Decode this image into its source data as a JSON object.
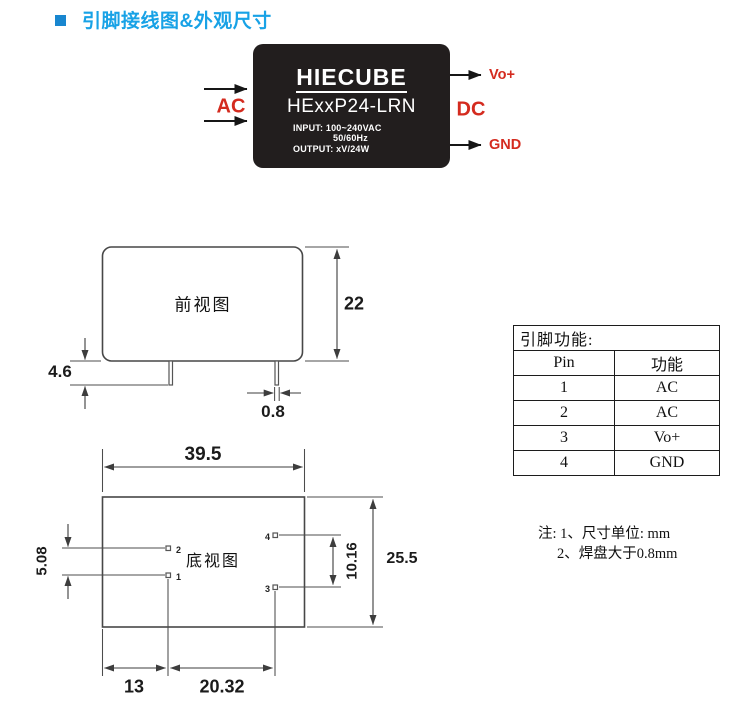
{
  "header": {
    "title": "引脚接线图&外观尺寸"
  },
  "module": {
    "brand": "HIECUBE",
    "model": "HExxP24-LRN",
    "spec_input": "INPUT: 100~240VAC",
    "spec_freq": "50/60Hz",
    "spec_output": "OUTPUT: xV/24W",
    "input_label": "AC",
    "output_label": "DC",
    "pin_vo_label": "Vo+",
    "pin_gnd_label": "GND"
  },
  "front_view": {
    "label": "前视图",
    "dim_height": "22",
    "dim_pin_length": "4.6",
    "dim_pin_width": "0.8"
  },
  "bottom_view": {
    "label": "底视图",
    "dim_width": "39.5",
    "dim_pitch_left": "5.08",
    "dim_depth": "25.5",
    "dim_pitch_right": "10.16",
    "dim_left_offset": "13",
    "dim_pin_span": "20.32",
    "pin1": "1",
    "pin2": "2",
    "pin3": "3",
    "pin4": "4"
  },
  "pin_table": {
    "title": "引脚功能:",
    "col_pin": "Pin",
    "col_func": "功能",
    "rows": [
      {
        "pin": "1",
        "func": "AC"
      },
      {
        "pin": "2",
        "func": "AC"
      },
      {
        "pin": "3",
        "func": "Vo+"
      },
      {
        "pin": "4",
        "func": "GND"
      }
    ]
  },
  "notes": {
    "line1": "注: 1、尺寸单位: mm",
    "line2": "2、焊盘大于0.8mm"
  },
  "colors": {
    "accent_blue": "#18a2e6",
    "label_red": "#d42b1f",
    "module_black": "#221e1e"
  }
}
